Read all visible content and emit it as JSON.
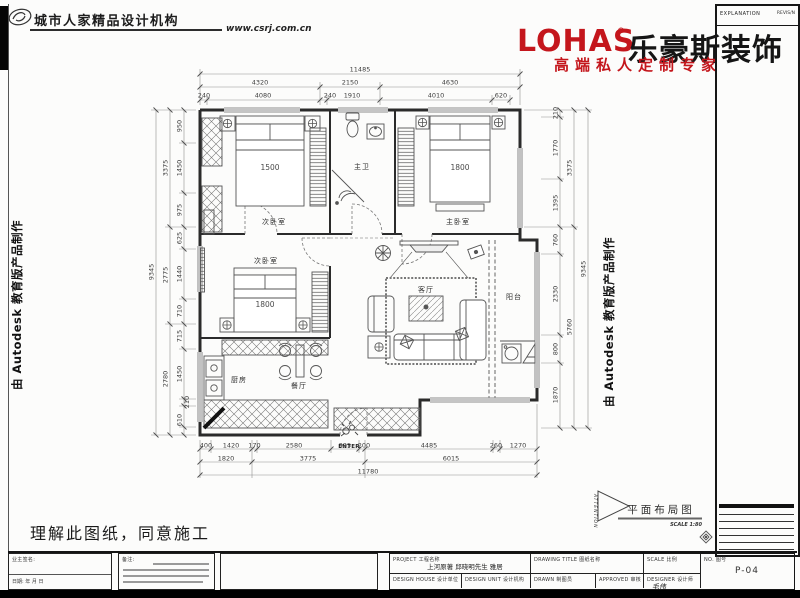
{
  "header": {
    "agency": "城市人家精品设计机构",
    "website": "www.csrj.com.cn"
  },
  "brand": {
    "latin": "LOHAS",
    "reg": "®",
    "name_cn": "乐豪斯装饰",
    "tagline": "高端私人定制专家",
    "red": "#c4161c"
  },
  "watermark": {
    "left": "由 Autodesk 教育版产品制作",
    "right": "由 Autodesk 教育版产品制作"
  },
  "explanation": {
    "title": "EXPLANATION",
    "revision": "REVIS/N"
  },
  "plan": {
    "rooms": {
      "bedroom1": "次卧室",
      "bedroom2": "次卧室",
      "master": "主卧室",
      "bath": "主卫",
      "living": "客厅",
      "dining": "餐厅",
      "kitchen": "厨房",
      "balcony": "阳台"
    },
    "beds": {
      "bedroom1": "1500",
      "master": "1800",
      "bedroom2": "1800"
    },
    "enter": "ENTER",
    "dims": {
      "top1": [
        "11485"
      ],
      "top2": [
        "4320",
        "2150",
        "4630"
      ],
      "top3": [
        "240",
        "4080",
        "240",
        "1910",
        "4010",
        "620"
      ],
      "left1": [
        "9345"
      ],
      "left2": [
        "3375",
        "2775",
        "2780"
      ],
      "left3": [
        "950",
        "1450",
        "975",
        "625",
        "1440",
        "710",
        "715",
        "1450",
        "210",
        "610"
      ],
      "right1": [
        "9345"
      ],
      "right2": [
        "3375",
        "5760"
      ],
      "right3": [
        "210",
        "1770",
        "1395",
        "760",
        "2330",
        "800",
        "1870"
      ],
      "bottom1": [
        "400",
        "1420",
        "170",
        "2580",
        "995",
        "200",
        "4485",
        "260",
        "1270"
      ],
      "bottom2": [
        "1820",
        "3775",
        "6015"
      ],
      "bottom3": [
        "11780"
      ]
    }
  },
  "figure": {
    "attention": "ATTENTION",
    "title": "平面布局图",
    "scale": "SCALE 1:80"
  },
  "approval": "理解此图纸，同意施工",
  "titleblock": {
    "owner_sign": "业主签名:",
    "date": "日期:      年    月    日",
    "remark": "备注:",
    "project_label": "PROJECT  工程名称",
    "project_value": "上河原著 邱晓明先生 雅居",
    "design_house_label": "DESIGN HOUSE 设计单位",
    "design_unit_label": "DESIGN UNIT 设计机构",
    "drawing_title_label": "DRAWING TITLE 图纸名称",
    "drawn_label": "DRAWN 制图员",
    "approved_label": "APPROVED 审核",
    "scale_label": "SCALE 比例",
    "designer_label": "DESIGNER 设计师",
    "designer_value": "毛伟",
    "no_label": "NO. 图号",
    "no_value": "P-04"
  }
}
